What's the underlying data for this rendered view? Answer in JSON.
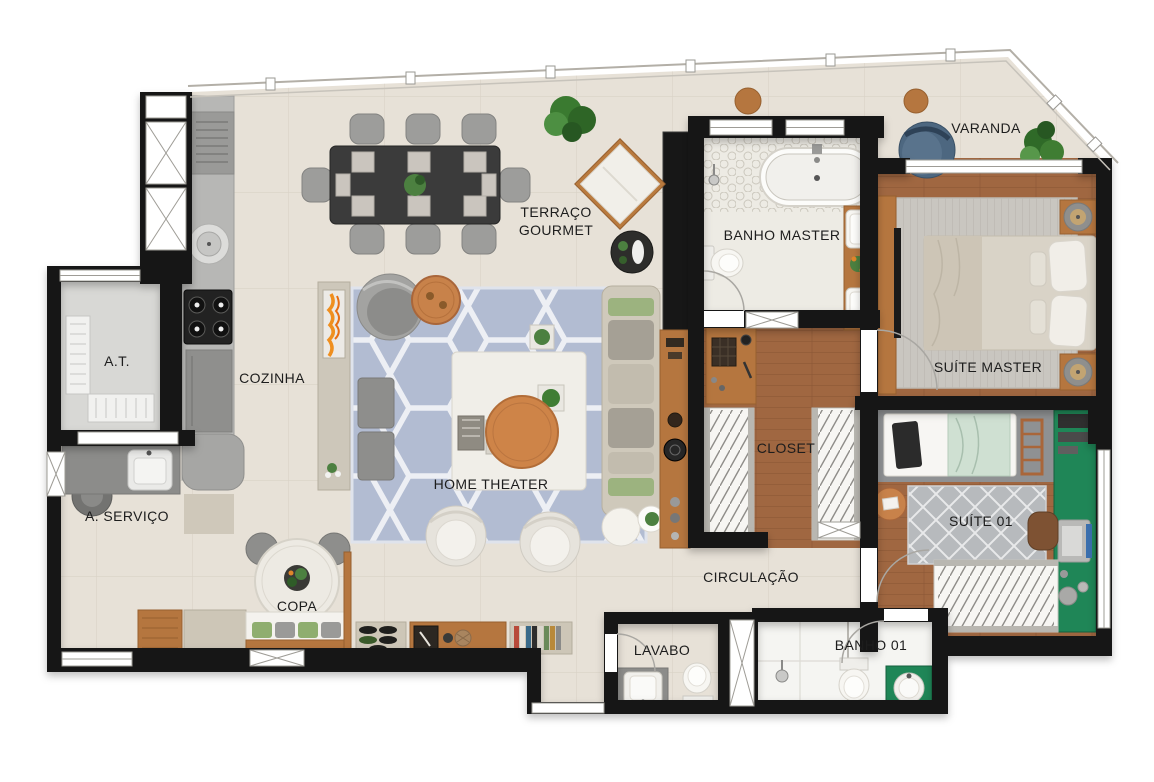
{
  "rooms": [
    {
      "id": "terraco-gourmet",
      "label": "TERRAÇO GOURMET"
    },
    {
      "id": "varanda",
      "label": "VARANDA"
    },
    {
      "id": "banho-master",
      "label": "BANHO MASTER"
    },
    {
      "id": "suite-master",
      "label": "SUÍTE MASTER"
    },
    {
      "id": "at",
      "label": "A.T."
    },
    {
      "id": "cozinha",
      "label": "COZINHA"
    },
    {
      "id": "home-theater",
      "label": "HOME THEATER"
    },
    {
      "id": "closet",
      "label": "CLOSET"
    },
    {
      "id": "a-servico",
      "label": "A. SERVIÇO"
    },
    {
      "id": "copa",
      "label": "COPA"
    },
    {
      "id": "circulacao",
      "label": "CIRCULAÇÃO"
    },
    {
      "id": "suite-01",
      "label": "SUÍTE 01"
    },
    {
      "id": "lavabo",
      "label": "LAVABO"
    },
    {
      "id": "banho-01",
      "label": "BANHO 01"
    }
  ],
  "palette": {
    "wall": "#141414",
    "floor_tile": "#e7e1d7",
    "wood_floor": "#a06741",
    "wood_furniture": "#b5763f",
    "rug_living": "#b2bcd2",
    "rug_gray": "#c9c6c0",
    "accent_green": "#1f8657",
    "sofa_beige": "#cfc9bb",
    "blue_chair": "#4d6780",
    "flame_orange": "#ef8f1f",
    "background": "#ffffff"
  }
}
